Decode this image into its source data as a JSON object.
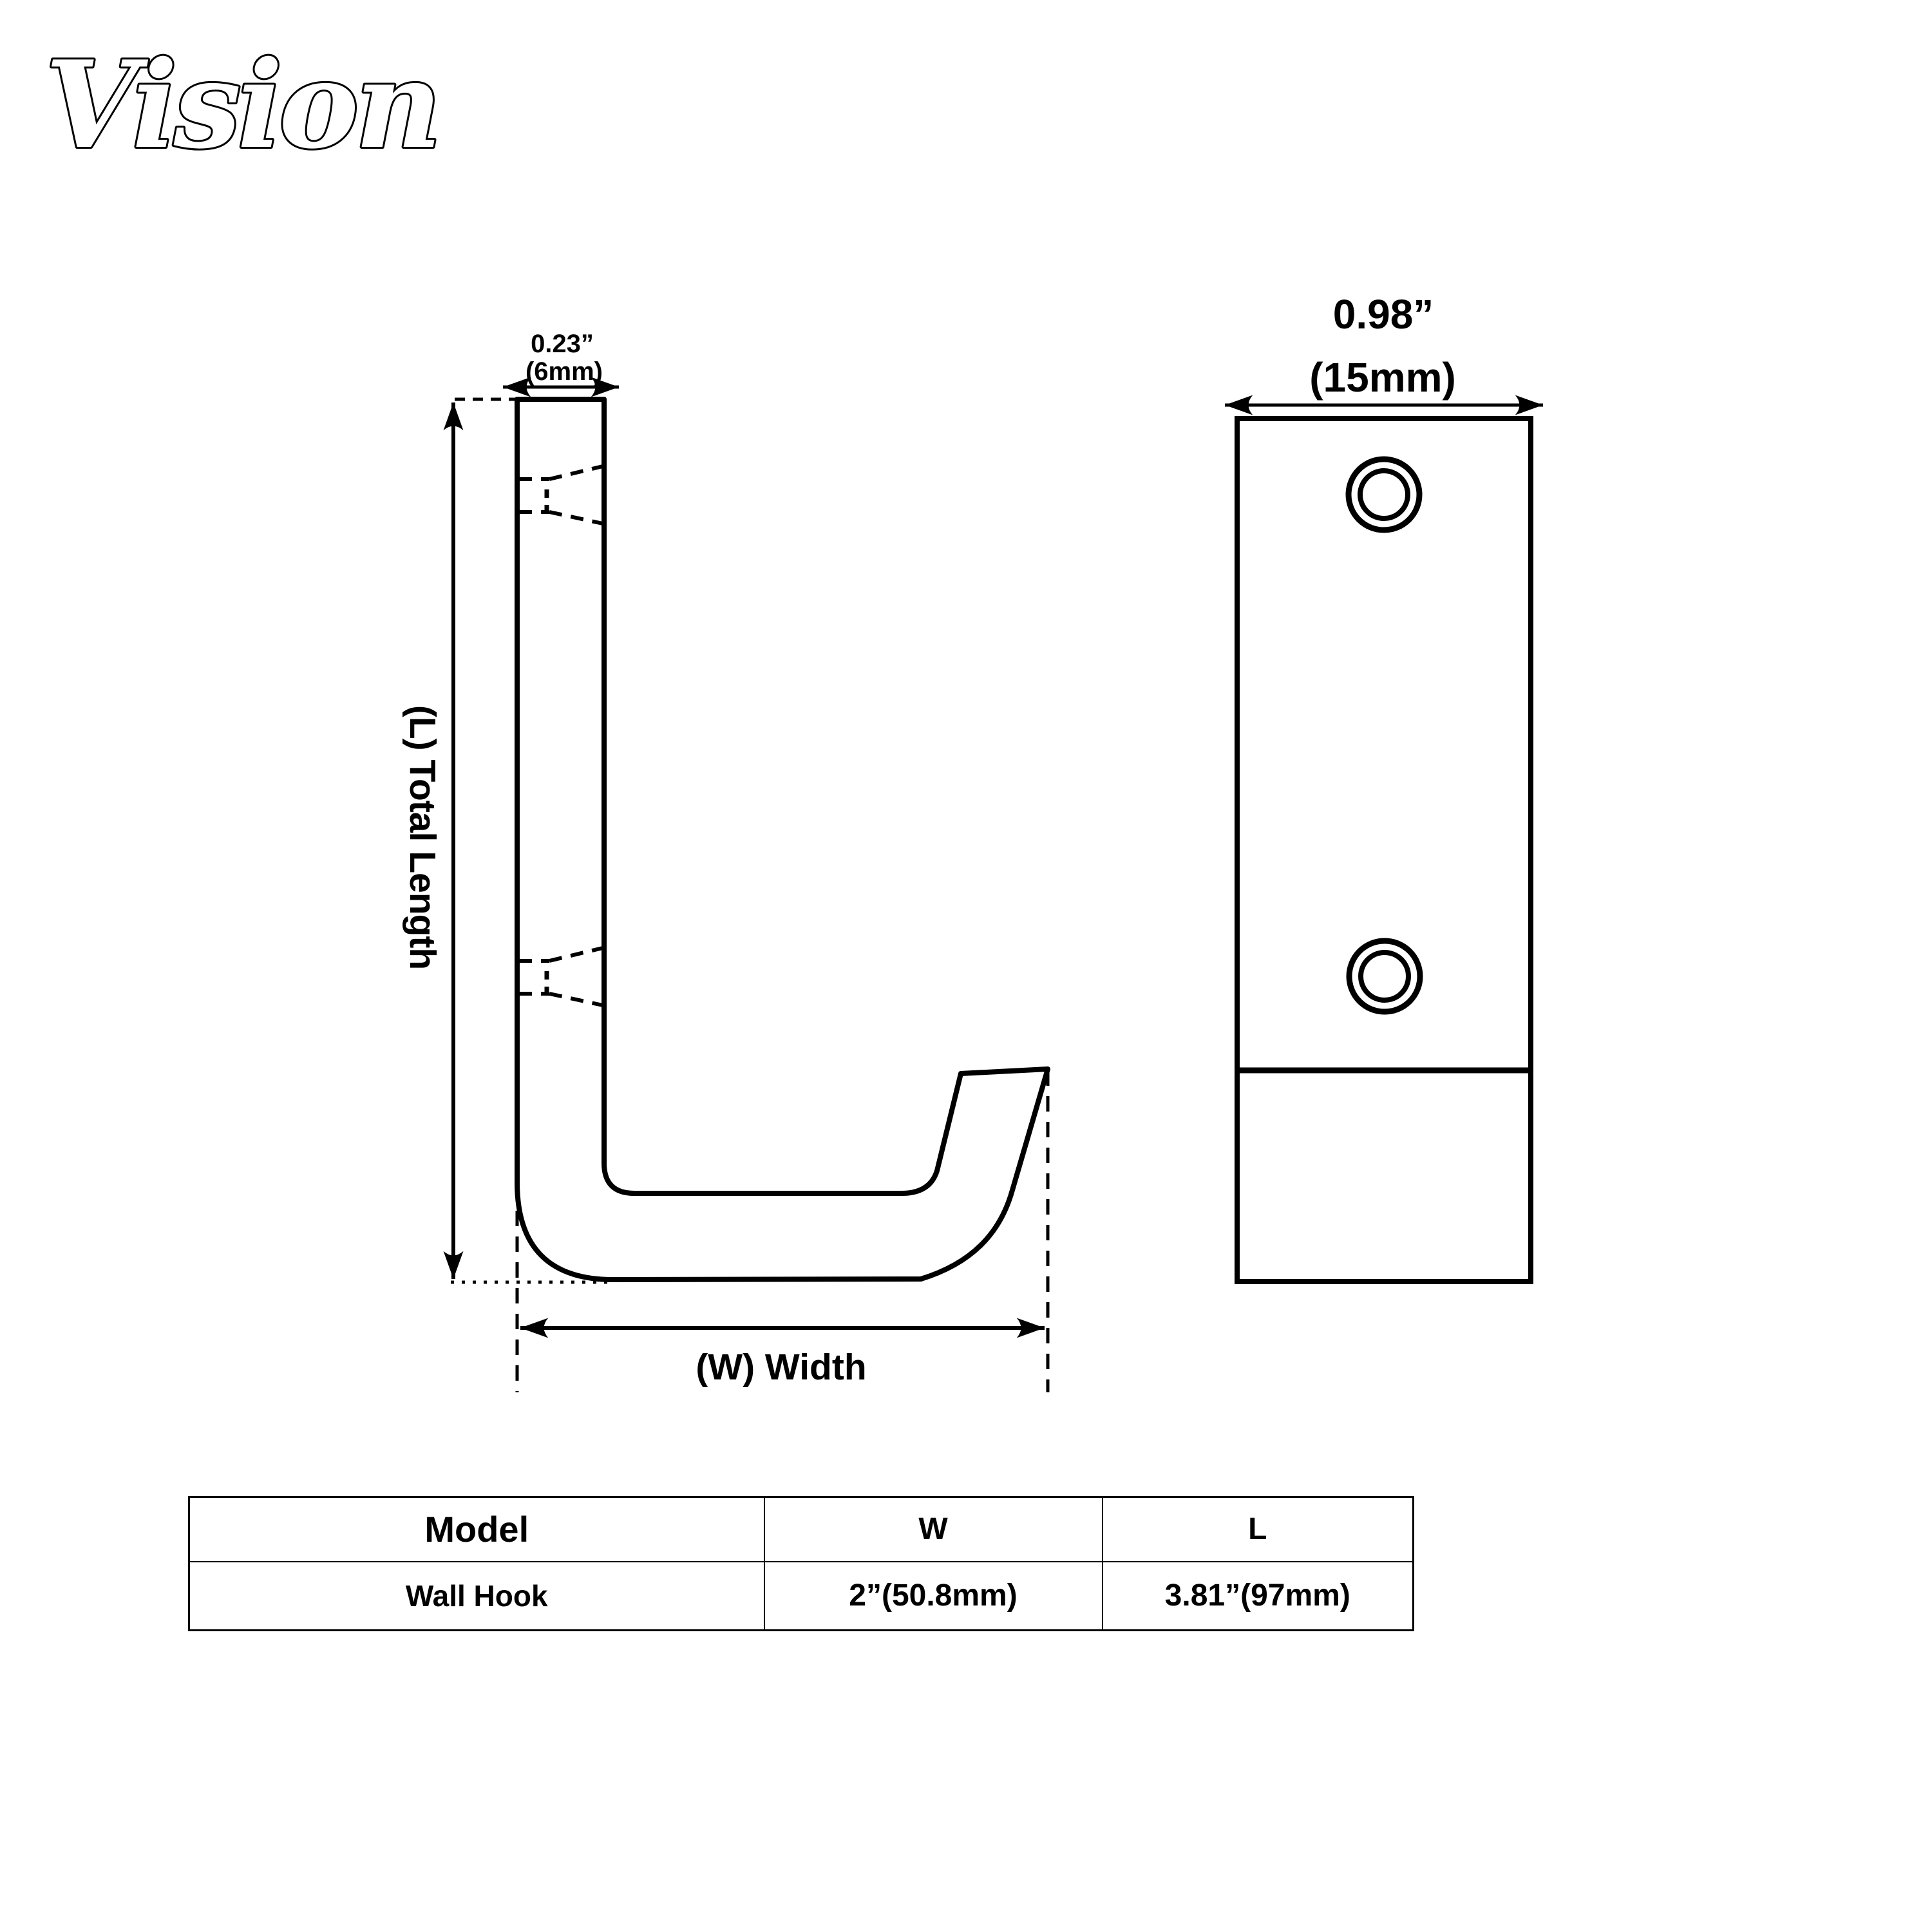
{
  "page": {
    "background": "#ffffff",
    "line_color": "#000000"
  },
  "brand": {
    "logo_text": "Vision"
  },
  "side_view": {
    "thickness_inches": "0.23”",
    "thickness_mm": "(6mm)",
    "length_label": "(L) Total Length",
    "width_label": "(W) Width"
  },
  "front_view": {
    "width_inches": "0.98”",
    "width_mm": "(15mm)"
  },
  "spec_table": {
    "headers": [
      "Model",
      "W",
      "L"
    ],
    "rows": [
      [
        "Wall Hook",
        "2”(50.8mm)",
        "3.81”(97mm)"
      ]
    ]
  }
}
